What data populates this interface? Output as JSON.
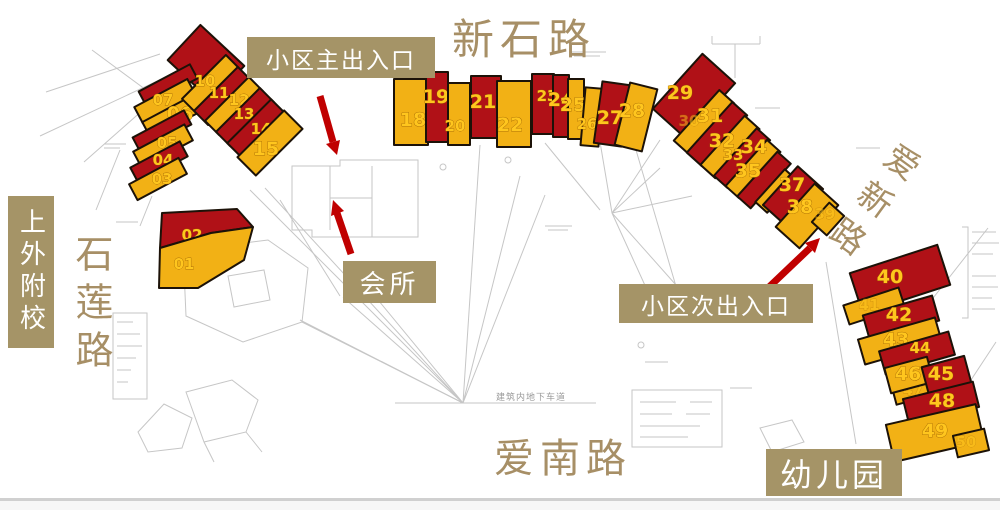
{
  "roads": {
    "xinshi": "新石路",
    "aixin": "爱新路",
    "ainan": "爱南路",
    "shilian": "石莲路"
  },
  "labels": {
    "school": "上外附校",
    "main_entrance": "小区主出入口",
    "clubhouse": "会所",
    "secondary_entrance": "小区次出入口",
    "kindergarten": "幼儿园"
  },
  "annotations": {
    "underground_note": "建筑内地下车道"
  },
  "colors": {
    "building_red": "#b01117",
    "building_yellow": "#f2b115",
    "building_outline": "#1c1208",
    "number_text": "#ffc61e",
    "label_bg": "#a59467",
    "label_text": "#ffffff",
    "road_text": "#a78f66",
    "arrow_red": "#c00000",
    "line_gray": "#c6c6c6"
  },
  "buildings": [
    {
      "label": "",
      "color": "red",
      "x": 206,
      "y": 63,
      "w": 60,
      "h": 48,
      "r": 43
    },
    {
      "label": "",
      "color": "red",
      "x": 168,
      "y": 85,
      "w": 58,
      "h": 16,
      "r": -28
    },
    {
      "label": "07",
      "color": "yellow",
      "x": 165,
      "y": 101,
      "w": 60,
      "h": 18,
      "r": -28,
      "lx": 163,
      "ly": 105
    },
    {
      "label": "06",
      "color": "yellow",
      "x": 173,
      "y": 116,
      "w": 60,
      "h": 18,
      "r": -28,
      "lx": 180,
      "ly": 120,
      "big": true
    },
    {
      "label": "",
      "color": "red",
      "x": 162,
      "y": 131,
      "w": 58,
      "h": 16,
      "r": -28
    },
    {
      "label": "05",
      "color": "yellow",
      "x": 163,
      "y": 146,
      "w": 58,
      "h": 18,
      "r": -28,
      "lx": 167,
      "ly": 148
    },
    {
      "label": "04",
      "color": "red",
      "x": 159,
      "y": 162,
      "w": 56,
      "h": 17,
      "r": -28,
      "lx": 163,
      "ly": 165
    },
    {
      "label": "03",
      "color": "yellow",
      "x": 158,
      "y": 179,
      "w": 56,
      "h": 18,
      "r": -28,
      "lx": 162,
      "ly": 184
    },
    {
      "label": "10",
      "color": "yellow",
      "x": 211,
      "y": 84,
      "w": 20,
      "h": 62,
      "r": 45,
      "lx": 205,
      "ly": 86
    },
    {
      "label": "11",
      "color": "red",
      "x": 223,
      "y": 96,
      "w": 20,
      "h": 62,
      "r": 45,
      "lx": 219,
      "ly": 98
    },
    {
      "label": "12",
      "color": "yellow",
      "x": 234,
      "y": 106,
      "w": 20,
      "h": 62,
      "r": 45,
      "lx": 239,
      "ly": 105
    },
    {
      "label": "13",
      "color": "red",
      "x": 245,
      "y": 117,
      "w": 20,
      "h": 62,
      "r": 45,
      "lx": 244,
      "ly": 119
    },
    {
      "label": "14",
      "color": "red",
      "x": 257,
      "y": 129,
      "w": 22,
      "h": 62,
      "r": 45,
      "lx": 261,
      "ly": 134
    },
    {
      "label": "15",
      "color": "yellow",
      "x": 270,
      "y": 143,
      "w": 26,
      "h": 66,
      "r": 45,
      "lx": 266,
      "ly": 155,
      "big": true
    },
    {
      "label": "02",
      "color": "red",
      "points": [
        [
          162,
          213
        ],
        [
          237,
          209
        ],
        [
          253,
          227
        ],
        [
          211,
          233
        ],
        [
          160,
          248
        ]
      ],
      "lx": 192,
      "ly": 240
    },
    {
      "label": "01",
      "color": "yellow",
      "points": [
        [
          160,
          248
        ],
        [
          211,
          233
        ],
        [
          253,
          227
        ],
        [
          244,
          260
        ],
        [
          198,
          288
        ],
        [
          159,
          288
        ]
      ],
      "lx": 184,
      "ly": 269
    },
    {
      "label": "18",
      "color": "yellow",
      "x": 411,
      "y": 112,
      "w": 34,
      "h": 66,
      "r": 0,
      "lx": 413,
      "ly": 126,
      "big": true
    },
    {
      "label": "19",
      "color": "red",
      "x": 437,
      "y": 107,
      "w": 22,
      "h": 70,
      "r": 0,
      "lx": 436,
      "ly": 103,
      "big": true
    },
    {
      "label": "20",
      "color": "yellow",
      "x": 459,
      "y": 114,
      "w": 22,
      "h": 62,
      "r": 0,
      "lx": 455,
      "ly": 131
    },
    {
      "label": "21",
      "color": "red",
      "x": 486,
      "y": 107,
      "w": 30,
      "h": 62,
      "r": 0,
      "lx": 483,
      "ly": 108,
      "big": true
    },
    {
      "label": "22",
      "color": "yellow",
      "x": 514,
      "y": 114,
      "w": 34,
      "h": 66,
      "r": 0,
      "lx": 510,
      "ly": 131,
      "big": true
    },
    {
      "label": "23",
      "color": "red",
      "x": 543,
      "y": 104,
      "w": 22,
      "h": 60,
      "r": 0,
      "lx": 547,
      "ly": 101
    },
    {
      "label": "24",
      "color": "red",
      "x": 561,
      "y": 106,
      "w": 16,
      "h": 62,
      "r": 0,
      "lx": 561,
      "ly": 106,
      "big": true
    },
    {
      "label": "25",
      "color": "yellow",
      "x": 576,
      "y": 109,
      "w": 16,
      "h": 60,
      "r": 0,
      "lx": 573,
      "ly": 111,
      "big": true
    },
    {
      "label": "26",
      "color": "yellow",
      "x": 592,
      "y": 117,
      "w": 18,
      "h": 58,
      "r": 5,
      "lx": 587,
      "ly": 129
    },
    {
      "label": "27",
      "color": "red",
      "x": 612,
      "y": 114,
      "w": 28,
      "h": 62,
      "r": 8,
      "lx": 610,
      "ly": 124,
      "big": true
    },
    {
      "label": "28",
      "color": "yellow",
      "x": 636,
      "y": 117,
      "w": 28,
      "h": 64,
      "r": 14,
      "lx": 632,
      "ly": 117,
      "big": true
    },
    {
      "label": "29",
      "color": "red",
      "x": 694,
      "y": 96,
      "w": 74,
      "h": 44,
      "r": -48,
      "lx": 680,
      "ly": 99,
      "big": true
    },
    {
      "label": "30",
      "color": "yellow",
      "x": 704,
      "y": 122,
      "w": 68,
      "h": 20,
      "r": -48,
      "lx": 689,
      "ly": 126,
      "faint": true
    },
    {
      "label": "31",
      "color": "red",
      "x": 717,
      "y": 134,
      "w": 68,
      "h": 20,
      "r": -48,
      "lx": 710,
      "ly": 122,
      "big": true
    },
    {
      "label": "32",
      "color": "yellow",
      "x": 730,
      "y": 147,
      "w": 66,
      "h": 20,
      "r": -48,
      "lx": 722,
      "ly": 147,
      "big": true
    },
    {
      "label": "33",
      "color": "red",
      "x": 742,
      "y": 158,
      "w": 64,
      "h": 18,
      "r": -48,
      "lx": 733,
      "ly": 160
    },
    {
      "label": "34",
      "color": "yellow",
      "x": 753,
      "y": 169,
      "w": 62,
      "h": 18,
      "r": -48,
      "lx": 754,
      "ly": 153,
      "big": true
    },
    {
      "label": "35",
      "color": "red",
      "x": 764,
      "y": 180,
      "w": 60,
      "h": 18,
      "r": -48,
      "lx": 748,
      "ly": 177,
      "big": true
    },
    {
      "label": "",
      "color": "yellow",
      "x": 776,
      "y": 191,
      "w": 44,
      "h": 16,
      "r": -48
    },
    {
      "label": "37",
      "color": "red",
      "x": 793,
      "y": 197,
      "w": 52,
      "h": 34,
      "r": -48,
      "lx": 792,
      "ly": 191,
      "big": true
    },
    {
      "label": "38",
      "color": "yellow",
      "x": 807,
      "y": 216,
      "w": 58,
      "h": 32,
      "r": -48,
      "lx": 800,
      "ly": 213,
      "big": true
    },
    {
      "label": "39",
      "color": "yellow",
      "x": 828,
      "y": 219,
      "w": 26,
      "h": 20,
      "r": -48,
      "lx": 825,
      "ly": 219,
      "faint": true
    },
    {
      "label": "40",
      "color": "red",
      "x": 900,
      "y": 279,
      "w": 92,
      "h": 42,
      "r": -18,
      "lx": 890,
      "ly": 283,
      "big": true
    },
    {
      "label": "41",
      "color": "yellow",
      "x": 874,
      "y": 306,
      "w": 58,
      "h": 20,
      "r": -18,
      "lx": 869,
      "ly": 310,
      "faint": true
    },
    {
      "label": "42",
      "color": "red",
      "x": 901,
      "y": 318,
      "w": 72,
      "h": 26,
      "r": -16,
      "lx": 899,
      "ly": 321,
      "big": true
    },
    {
      "label": "43",
      "color": "yellow",
      "x": 900,
      "y": 341,
      "w": 80,
      "h": 26,
      "r": -16,
      "lx": 896,
      "ly": 346,
      "big": true
    },
    {
      "label": "44",
      "color": "red",
      "x": 917,
      "y": 353,
      "w": 72,
      "h": 24,
      "r": -16,
      "lx": 920,
      "ly": 353
    },
    {
      "label": "47",
      "color": "yellow",
      "x": 917,
      "y": 392,
      "w": 46,
      "h": 14,
      "r": -15,
      "lx": 913,
      "ly": 395,
      "faint": true
    },
    {
      "label": "46",
      "color": "yellow",
      "x": 909,
      "y": 375,
      "w": 44,
      "h": 26,
      "r": -15,
      "lx": 908,
      "ly": 380,
      "big": true
    },
    {
      "label": "45",
      "color": "red",
      "x": 947,
      "y": 377,
      "w": 44,
      "h": 32,
      "r": -15,
      "lx": 941,
      "ly": 380,
      "big": true
    },
    {
      "label": "48",
      "color": "red",
      "x": 941,
      "y": 403,
      "w": 72,
      "h": 26,
      "r": -14,
      "lx": 942,
      "ly": 407,
      "big": true
    },
    {
      "label": "49",
      "color": "yellow",
      "x": 935,
      "y": 433,
      "w": 92,
      "h": 38,
      "r": -13,
      "lx": 935,
      "ly": 437,
      "big": true
    },
    {
      "label": "50",
      "color": "yellow",
      "x": 971,
      "y": 443,
      "w": 32,
      "h": 22,
      "r": -13,
      "lx": 966,
      "ly": 447,
      "faint": true
    }
  ]
}
